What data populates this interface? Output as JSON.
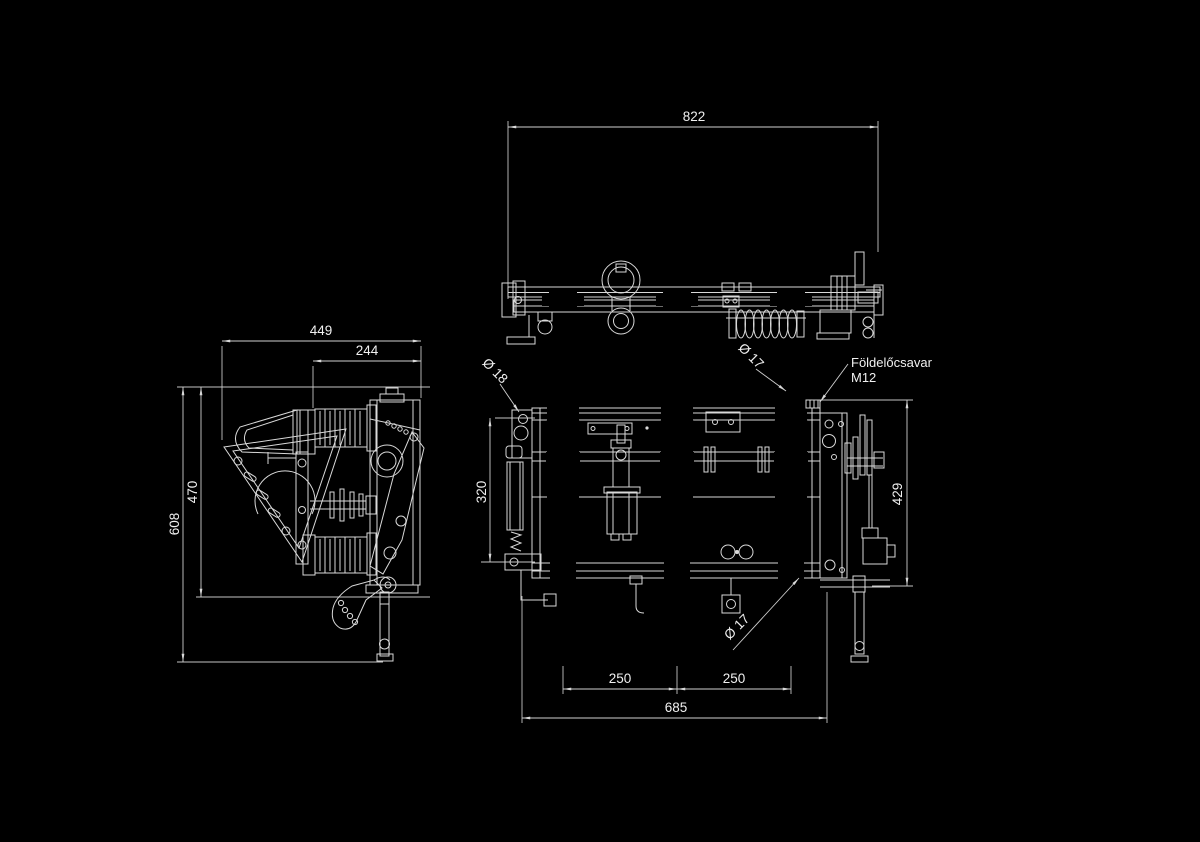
{
  "drawing": {
    "colors": {
      "background": "#000000",
      "line": "#d9d9d9",
      "text": "#f0f0f0"
    },
    "front_view": {
      "width_dim": "822"
    },
    "side_view": {
      "overall_width_dim": "449",
      "upper_width_dim": "244",
      "frame_height_dim": "470",
      "overall_height_dim": "608"
    },
    "plan_view": {
      "frame_depth_dim": "320",
      "overall_depth_dim": "429",
      "pole_spacing_left_dim": "250",
      "pole_spacing_right_dim": "250",
      "mounting_width_dim": "685",
      "hole_left_label": "Ø 18",
      "hole_right_label": "Ø 17",
      "hole_bottom_label": "Ø 17",
      "earthing_note_line1": "Földelőcsavar",
      "earthing_note_line2": "M12"
    }
  }
}
